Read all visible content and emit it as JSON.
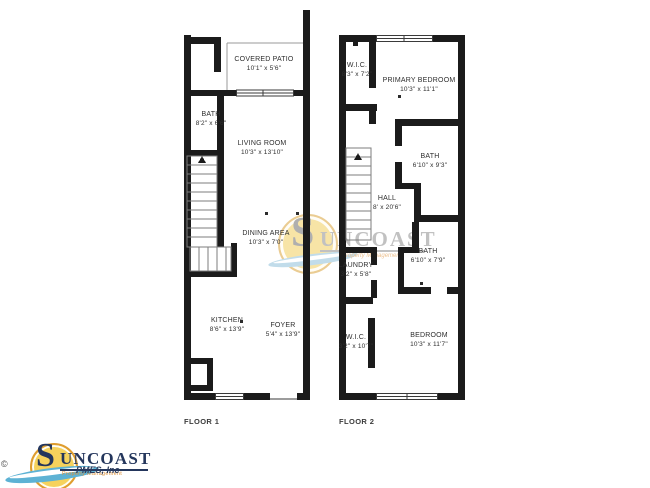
{
  "colors": {
    "wall": "#1b1b1b",
    "label_text": "#2e2e2e",
    "logo_navy": "#24365c",
    "logo_orange": "#dd8f35",
    "sun_yellow": "#f6d25c",
    "sun_ring": "#df9d2f",
    "swoosh_blue": "#5db2d4",
    "watermark_gray": "#8f8f8f"
  },
  "floors": [
    {
      "label": "FLOOR 1",
      "rooms": [
        {
          "name": "COVERED PATIO",
          "dims": "10'1\" x 5'6\""
        },
        {
          "name": "BATH",
          "dims": "8'2\" x 6'6\""
        },
        {
          "name": "LIVING ROOM",
          "dims": "10'3\" x 13'10\""
        },
        {
          "name": "DINING AREA",
          "dims": "10'3\" x 7'0\""
        },
        {
          "name": "KITCHEN",
          "dims": "8'6\" x 13'9\""
        },
        {
          "name": "FOYER",
          "dims": "5'4\" x 13'9\""
        }
      ]
    },
    {
      "label": "FLOOR 2",
      "rooms": [
        {
          "name": "W.I.C.",
          "dims": "8'3\" x 7'2\""
        },
        {
          "name": "PRIMARY BEDROOM",
          "dims": "10'3\" x 11'1\""
        },
        {
          "name": "BATH",
          "dims": "6'10\" x 9'3\""
        },
        {
          "name": "HALL",
          "dims": "8' x 20'6\""
        },
        {
          "name": "LAUNDRY",
          "dims": "3'2\" x 5'8\""
        },
        {
          "name": "BATH",
          "dims": "6'10\" x 7'9\""
        },
        {
          "name": "W.I.C.",
          "dims": "3'2\" x 10'7\""
        },
        {
          "name": "BEDROOM",
          "dims": "10'3\" x 11'7\""
        }
      ]
    }
  ],
  "watermark": {
    "brand_initial": "S",
    "brand_rest": "UNCOAST",
    "subtext": "Property Management"
  },
  "logo": {
    "copyright": "©",
    "brand_initial": "S",
    "brand_rest": "UNCOAST",
    "subtext": "Property Management",
    "overlay_text": "PMES, Inc"
  }
}
